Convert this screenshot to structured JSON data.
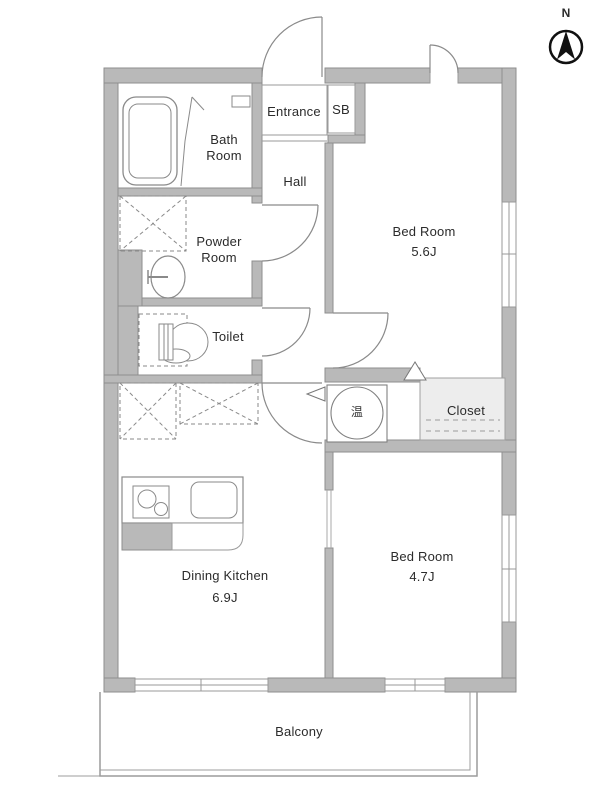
{
  "title": "Apartment floor plan",
  "compass": {
    "label": "N"
  },
  "rooms": {
    "entrance": {
      "label": "Entrance"
    },
    "shoe_box": {
      "label": "SB"
    },
    "bath": {
      "line1": "Bath",
      "line2": "Room"
    },
    "powder": {
      "line1": "Powder",
      "line2": "Room"
    },
    "toilet": {
      "label": "Toilet"
    },
    "hall": {
      "label": "Hall"
    },
    "bedroom1": {
      "line1": "Bed Room",
      "line2": "5.6J"
    },
    "bedroom2": {
      "line1": "Bed Room",
      "line2": "4.7J"
    },
    "dining_kitchen": {
      "line1": "Dining Kitchen",
      "line2": "6.9J"
    },
    "closet": {
      "label": "Closet"
    },
    "balcony": {
      "label": "Balcony"
    },
    "water_heater": {
      "label": "温"
    }
  },
  "colors": {
    "wall_fill": "#b9b9b9",
    "wall_outline": "#8e8e8e",
    "thin_line": "#999999",
    "door_line": "#8a8a8a",
    "closet_fill": "#ededed",
    "text": "#2b2b2b",
    "compass": "#111111",
    "background": "#ffffff"
  }
}
